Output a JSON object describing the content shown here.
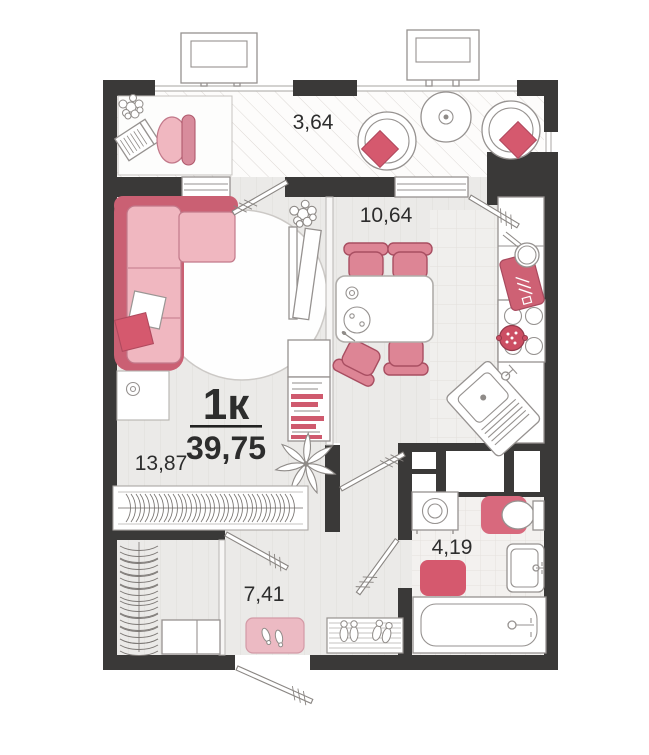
{
  "plan": {
    "apartment_type_label": "1к",
    "total_area_label": "39,75",
    "rooms": {
      "living_area": "13,87",
      "kitchen_area": "10,64",
      "hallway_area": "7,41",
      "bathroom_area": "4,19",
      "balcony_area": "3,64"
    },
    "colors": {
      "wall": "#3a3938",
      "accent_crimson": "#d5596e",
      "accent_pink": "#f0b7c0",
      "floor": "#ebeae8",
      "text": "#2d2d2d"
    }
  }
}
